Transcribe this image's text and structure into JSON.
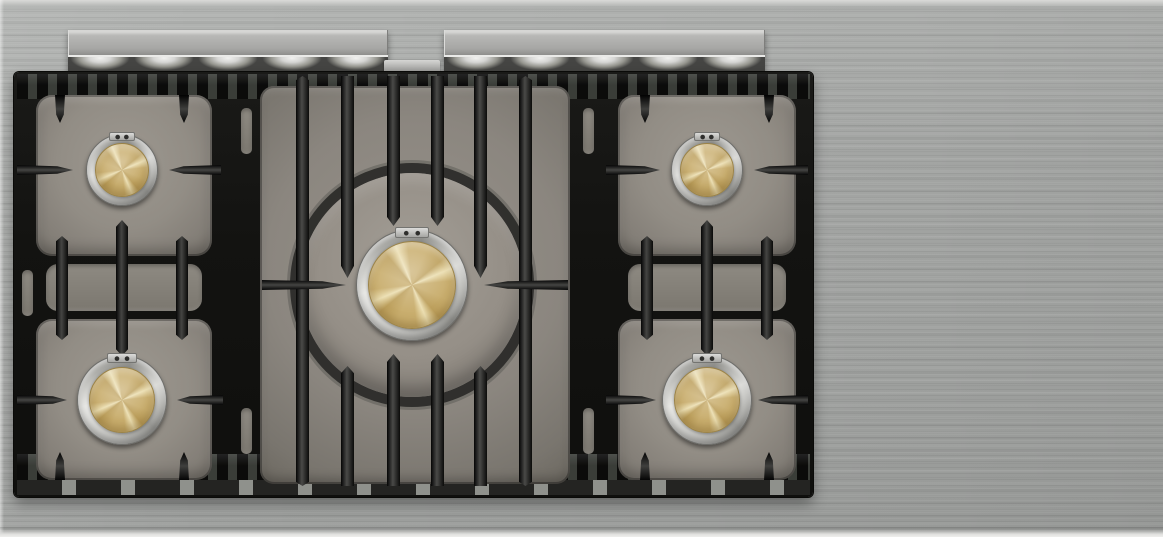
{
  "scene": {
    "title": "Overhead view of a five-burner brushed stainless steel gas range top with black cast-iron grates and brass burner caps",
    "appliance": "gas cooktop",
    "surface_finish": "brushed stainless steel",
    "grate_material": "black cast iron",
    "burner_count": 5,
    "rail_count": 2
  },
  "burners": {
    "rear_left": {
      "label": "Rear left burner",
      "size": "small",
      "cap_finish": "brass",
      "trim": "stainless ring"
    },
    "front_left": {
      "label": "Front left burner",
      "size": "medium",
      "cap_finish": "brass",
      "trim": "stainless ring"
    },
    "center": {
      "label": "Center power burner",
      "size": "large",
      "cap_finish": "brass",
      "trim": "stainless ring"
    },
    "rear_right": {
      "label": "Rear right burner",
      "size": "small",
      "cap_finish": "brass",
      "trim": "stainless ring"
    },
    "front_right": {
      "label": "Front right burner",
      "size": "medium",
      "cap_finish": "brass",
      "trim": "stainless ring"
    }
  },
  "parts": {
    "back_rail_left": "Stainless back trim rail (left)",
    "back_rail_right": "Stainless back trim rail (right)",
    "grate_assembly": "Black cast-iron pan supports",
    "center_clip": "Stainless mounting clip"
  },
  "colors": {
    "steel-base": "#a7a9a7",
    "steel-light": "#d6d6d4",
    "iron-black": "#131311",
    "iron-highlight": "#4a4a48",
    "pan-gray": "#8f8b83",
    "pan-light": "#a39e96",
    "pan-dark": "#6b675f",
    "brass-light": "#ecdfb2",
    "brass-mid": "#c9ae6e",
    "brass-dark": "#9b8348",
    "ring-light": "#e9e9e6",
    "ring-dark": "#8f8f8b"
  }
}
